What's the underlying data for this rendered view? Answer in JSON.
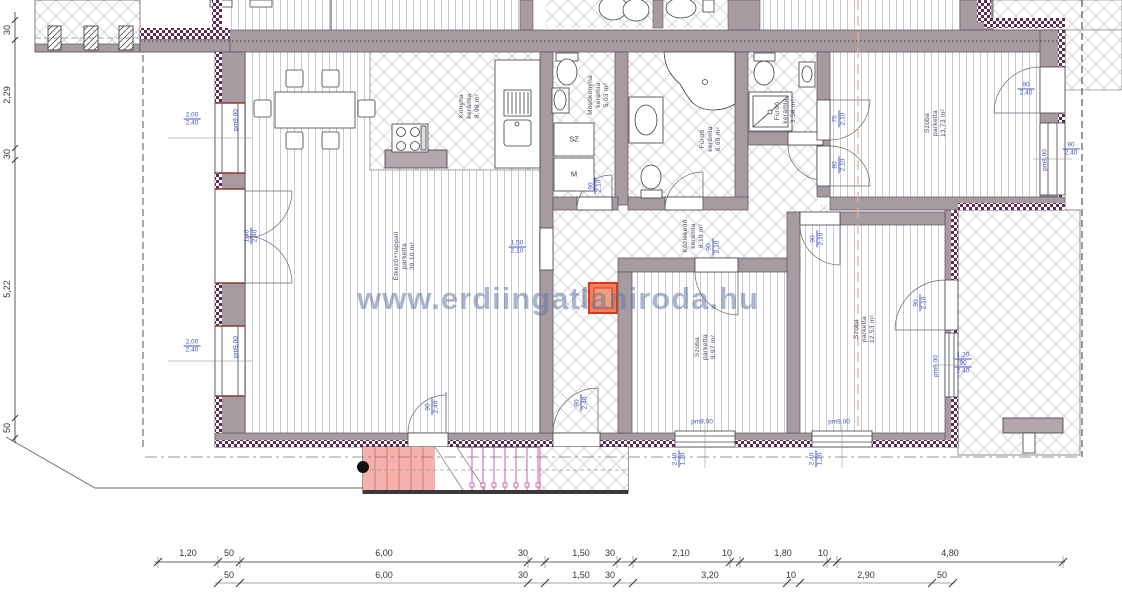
{
  "watermark": "www.erdiingatlaniroda.hu",
  "rooms": [
    {
      "lines": [
        "Étkező+nappali",
        "parketta",
        "39,10 m²"
      ]
    },
    {
      "lines": [
        "Konyha",
        "kerámia",
        "8,98 m²"
      ]
    },
    {
      "lines": [
        "Mosókonyha",
        "kerámia",
        "5,03 m²"
      ]
    },
    {
      "lines": [
        "Fürdő",
        "kerámia",
        "6,69 m²"
      ]
    },
    {
      "lines": [
        "Fürdő",
        "kerámia",
        "3,58 m²"
      ]
    },
    {
      "lines": [
        "Közlekedő",
        "kerámia",
        "6,10 m²"
      ]
    },
    {
      "lines": [
        "Szoba",
        "parketta",
        "9,97 m²"
      ]
    },
    {
      "lines": [
        "Szoba",
        "parketta",
        "12,53 m²"
      ]
    },
    {
      "lines": [
        "Szoba",
        "parketta",
        "13,73 m²"
      ]
    }
  ],
  "fixtures": {
    "washer": "SZ",
    "dryer": "M",
    "chimney": "Kémény"
  },
  "opening_labels": {
    "pm": "pm9,00",
    "w200": "2,00",
    "w240": "2,40",
    "w140": "1,40",
    "w150": "1,50",
    "w210": "2,10",
    "w90": "90",
    "w75": "75",
    "w80": "80",
    "w120": "1,20"
  },
  "left_dims": [
    "30",
    "2,29",
    "30",
    "5,22",
    "50"
  ],
  "dim_row_1": [
    "1,20",
    "50",
    "6,00",
    "30",
    "1,50",
    "30",
    "2,10",
    "10",
    "1,80",
    "10",
    "4,80"
  ],
  "dim_row_2": [
    "50",
    "6,00",
    "30",
    "1,50",
    "30",
    "3,20",
    "10",
    "2,90",
    "50"
  ]
}
